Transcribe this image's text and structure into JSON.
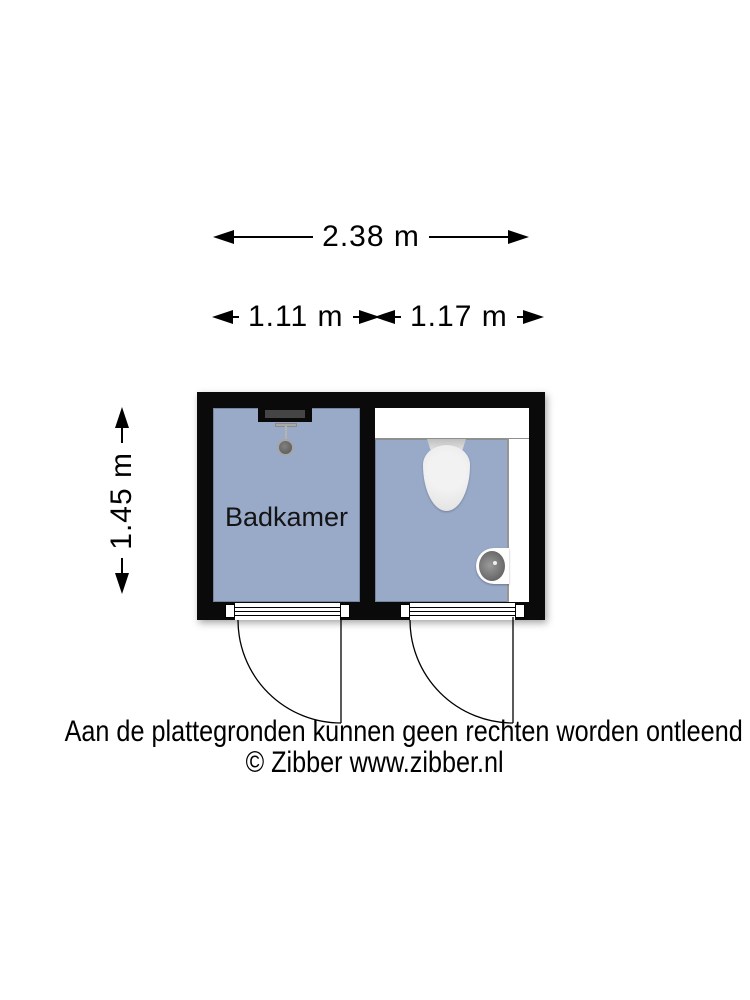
{
  "dimensions": {
    "total_width": {
      "label": "2.38 m"
    },
    "left_room_width": {
      "label": "1.11 m"
    },
    "right_room_width": {
      "label": "1.17 m"
    },
    "height": {
      "label": "1.45 m"
    }
  },
  "floorplan": {
    "rooms": [
      {
        "name": "badkamer",
        "label": "Badkamer",
        "fixtures": [
          "shower"
        ]
      },
      {
        "name": "toilet",
        "label": "",
        "fixtures": [
          "cistern",
          "toilet",
          "hand-basin"
        ]
      }
    ],
    "colors": {
      "wall": "#0a0a0a",
      "floor": "#99aac9",
      "fixture_white": "#ffffff"
    }
  },
  "footer": {
    "disclaimer": "Aan de plattegronden kunnen geen rechten worden ontleend",
    "copyright": "© Zibber www.zibber.nl"
  }
}
